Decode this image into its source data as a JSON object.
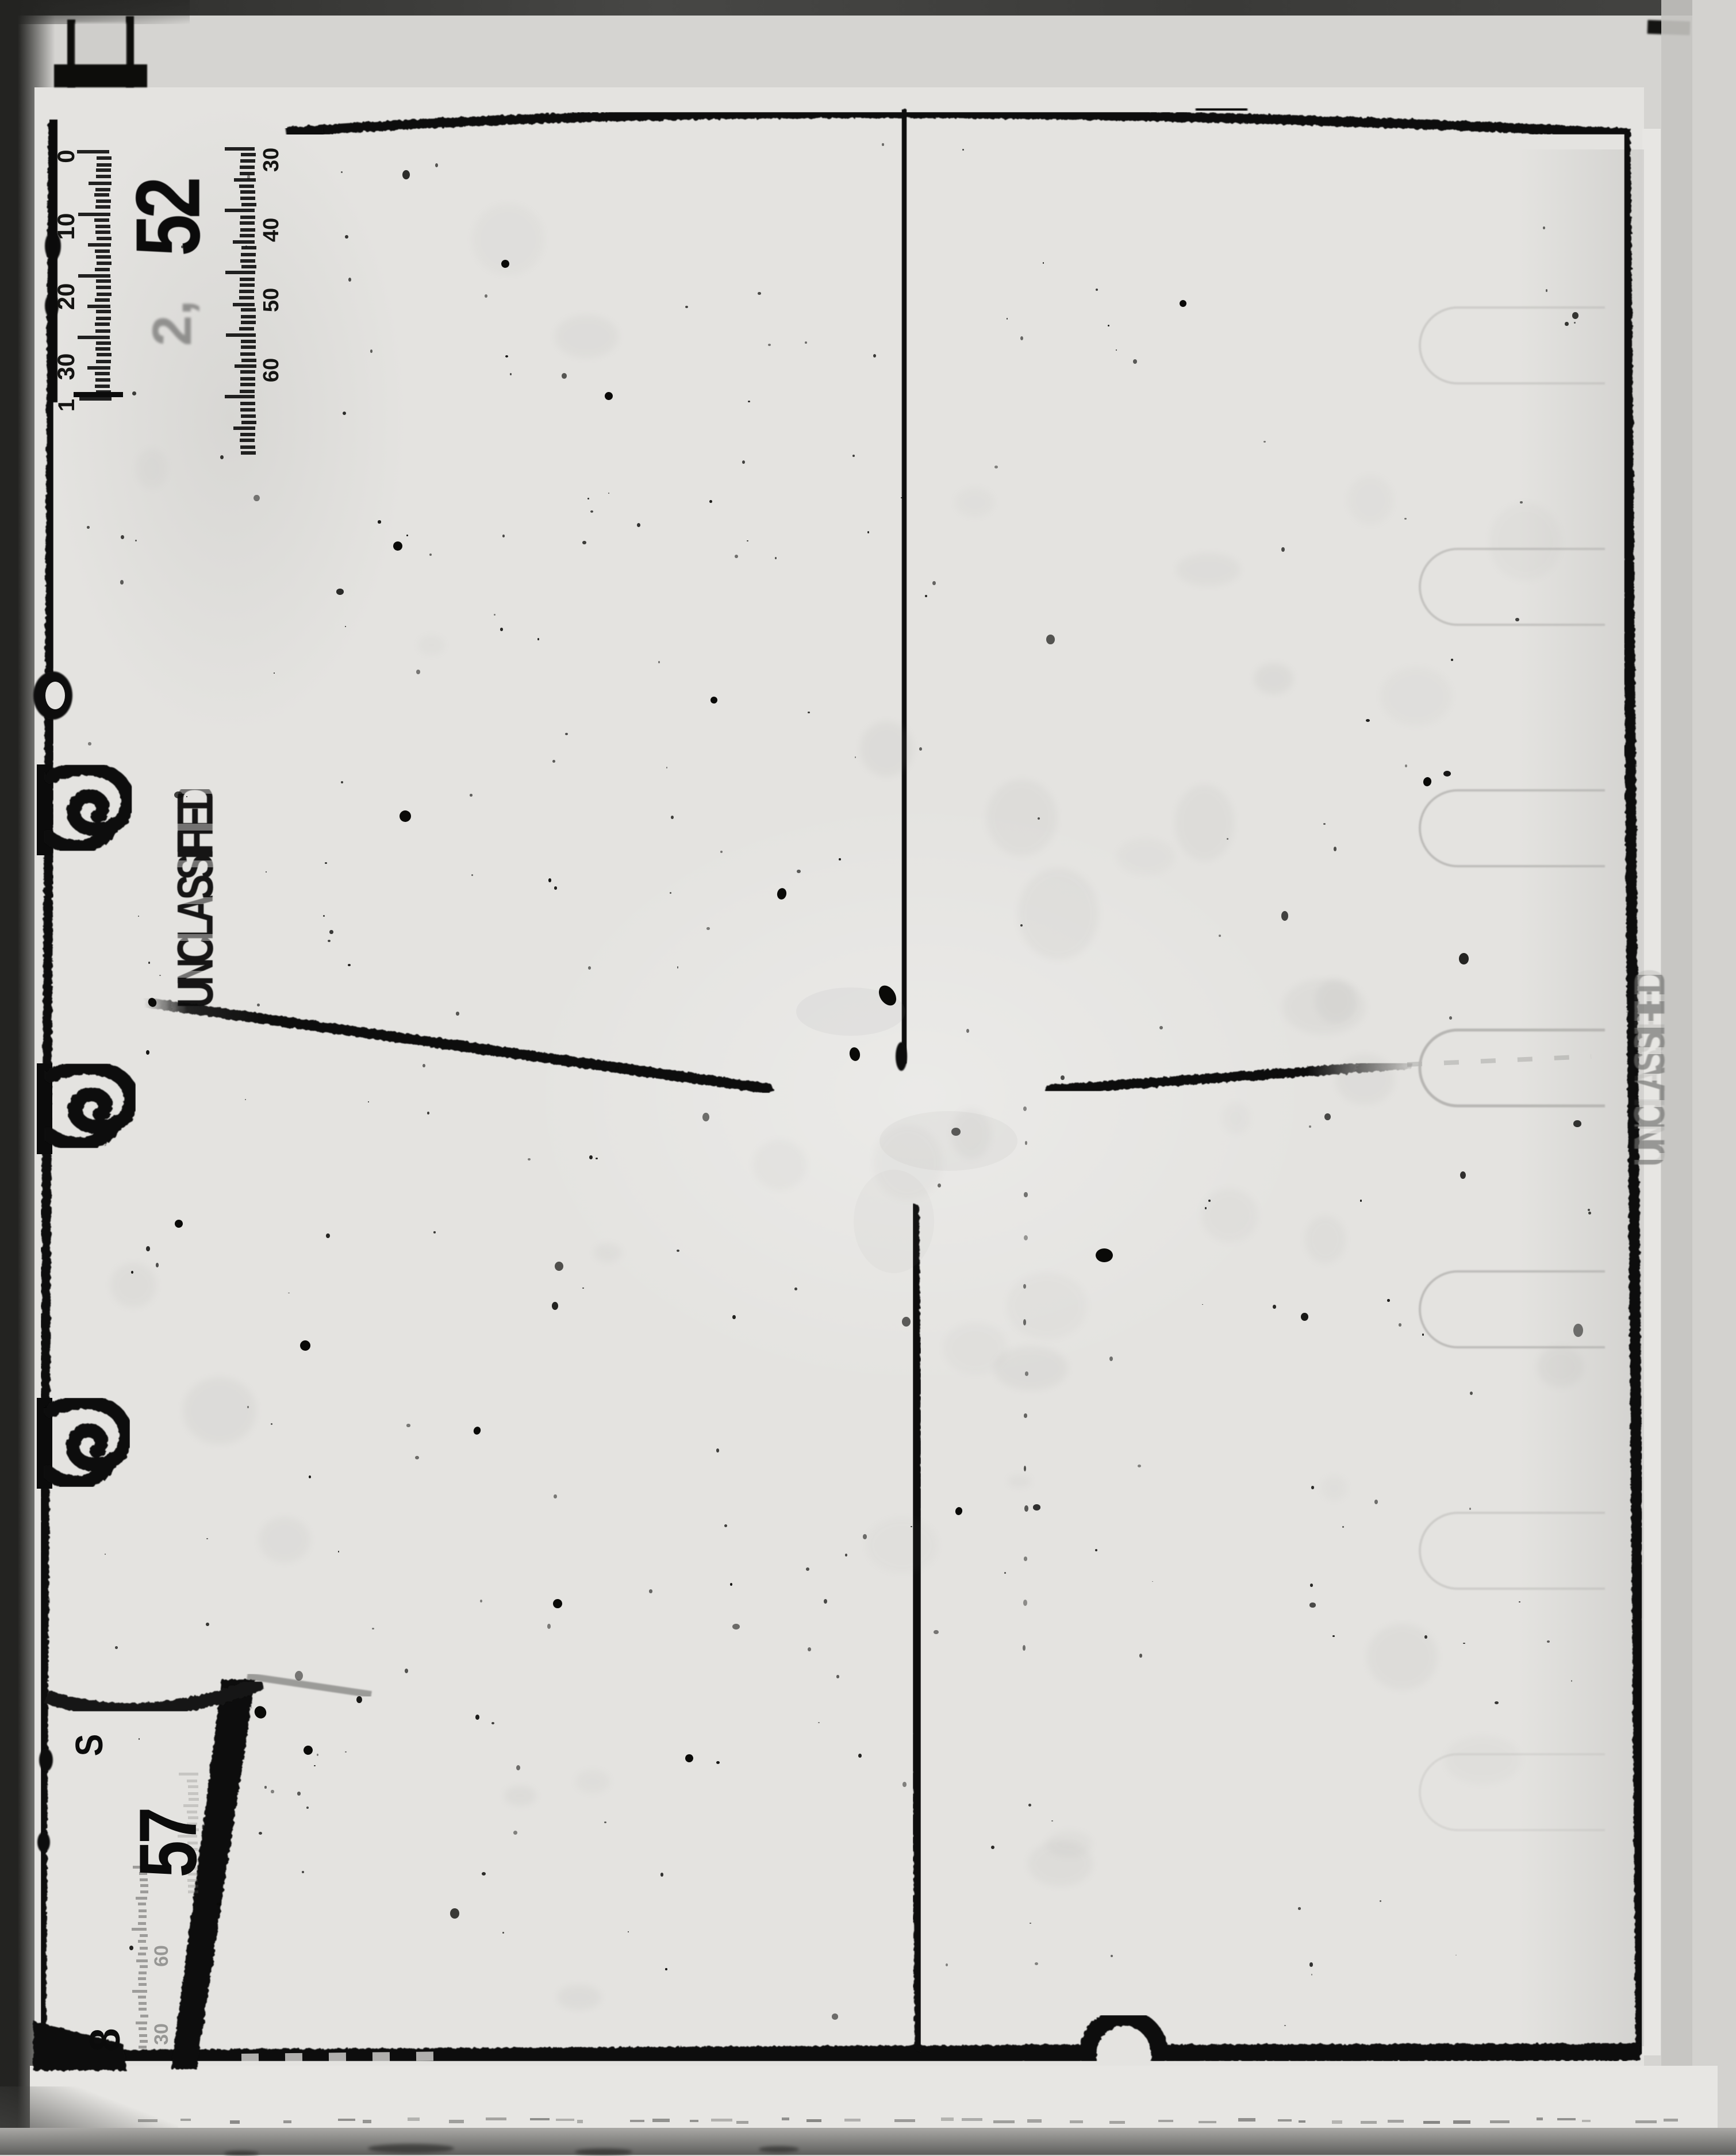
{
  "page": {
    "background": "#d5d4d1",
    "plate_background": "#e4e3e0",
    "ink": "#0b0b0b"
  },
  "colors": {
    "scan_edge": "#232321",
    "top_band": "#3a3a38",
    "gray_strip": "#c5c4c1",
    "below_strip": "#e7e6e3",
    "faint_ink": "#6f6f6d",
    "ghost_outline": "#b7b6b3"
  },
  "stamps": {
    "primary": "UNCLASSIFIED",
    "edge_ghost": "UNCLASSIFIED"
  },
  "plate_numbers": {
    "top": "52",
    "top_echo": "2,",
    "corner_prefix": "S",
    "corner_main": "57",
    "corner_suffix": "8"
  },
  "rulers": {
    "primary": {
      "labels": [
        "0",
        "10",
        "20",
        "30"
      ],
      "terminal": "1"
    },
    "secondary": {
      "labels": [
        "30",
        "40",
        "50",
        "60"
      ]
    },
    "corner": {
      "labels": [
        "60",
        "30"
      ]
    }
  },
  "icons": {
    "film_tab": "css-bracket-shape",
    "edge_hook": "css-curl-shape",
    "ghost_tab": "css-stadium-outline",
    "notch_arch": "css-arch-shape"
  },
  "noise": {
    "seed": 20240521,
    "speckle_count": 275,
    "mottle_count": 42
  }
}
